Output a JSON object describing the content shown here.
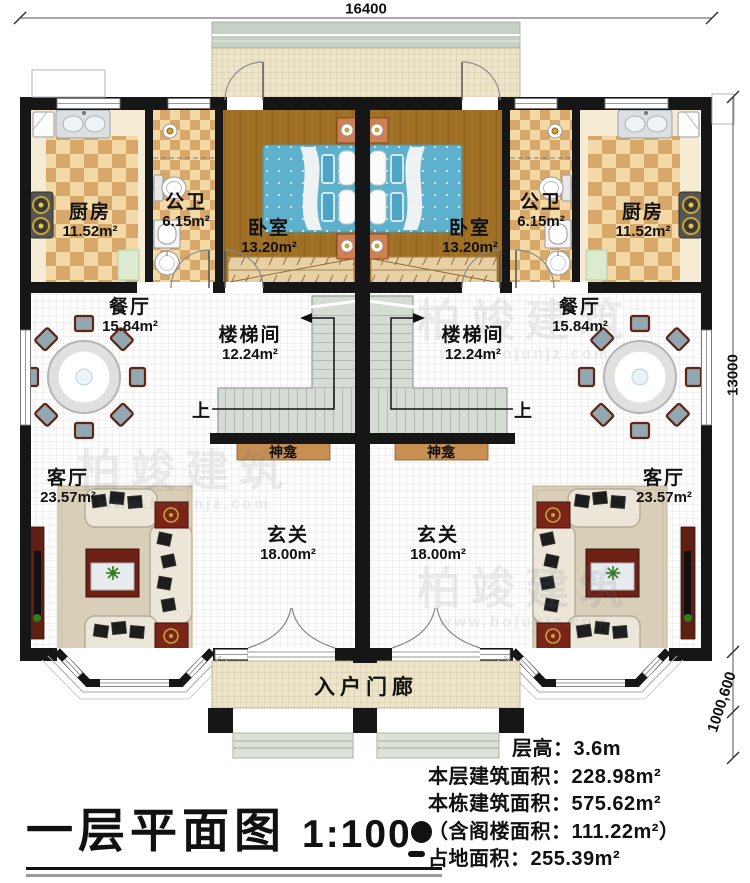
{
  "title": {
    "name": "一层平面图",
    "scale": "1:100"
  },
  "dimensions": {
    "top": "16400",
    "right": "13000",
    "right_bottom": "1000,600"
  },
  "rooms": {
    "kitchen_left": {
      "label": "厨房",
      "area": "11.52m²"
    },
    "bath_left": {
      "label": "公卫",
      "area": "6.15m²"
    },
    "bedroom_left": {
      "label": "卧室",
      "area": "13.20m²"
    },
    "bedroom_right": {
      "label": "卧室",
      "area": "13.20m²"
    },
    "bath_right": {
      "label": "公卫",
      "area": "6.15m²"
    },
    "kitchen_right": {
      "label": "厨房",
      "area": "11.52m²"
    },
    "dining_left": {
      "label": "餐厅",
      "area": "15.84m²"
    },
    "stairwell_left": {
      "label": "楼梯间",
      "area": "12.24m²"
    },
    "stairwell_right": {
      "label": "楼梯间",
      "area": "12.24m²"
    },
    "dining_right": {
      "label": "餐厅",
      "area": "15.84m²"
    },
    "living_left": {
      "label": "客厅",
      "area": "23.57m²"
    },
    "foyer_left": {
      "label": "玄关",
      "area": "18.00m²"
    },
    "foyer_right": {
      "label": "玄关",
      "area": "18.00m²"
    },
    "living_right": {
      "label": "客厅",
      "area": "23.57m²"
    }
  },
  "features": {
    "shrine_left": "神龛",
    "shrine_right": "神龛",
    "stair_up_left": "上",
    "stair_up_right": "上",
    "entry_porch": "入户门廊"
  },
  "info": {
    "lines": [
      "层高：3.6m",
      "本层建筑面积：228.98m²",
      "本栋建筑面积：575.62m²",
      "（含阁楼面积：111.22m²）",
      "占地面积：255.39m²"
    ]
  },
  "watermark": {
    "brand": "柏竣建筑",
    "url": "www.bojunjz.com"
  },
  "colors": {
    "wall": "#161616",
    "marble": "#f6ecd6",
    "checker_light": "#f2d9a6",
    "checker_dark": "#d8a86b",
    "wood": "#9f6f24",
    "bed": "#5eb1cd",
    "stair": "#d5dcd4",
    "shrine": "#c78f52",
    "porch": "#ece4cb",
    "porch_band": "#c6d1c5",
    "sofa": "#ece6d8",
    "rug": "#d9cfb8",
    "dark_red": "#5f1f12",
    "table_red": "#7a2517",
    "tile_white": "#fdfdfd"
  }
}
